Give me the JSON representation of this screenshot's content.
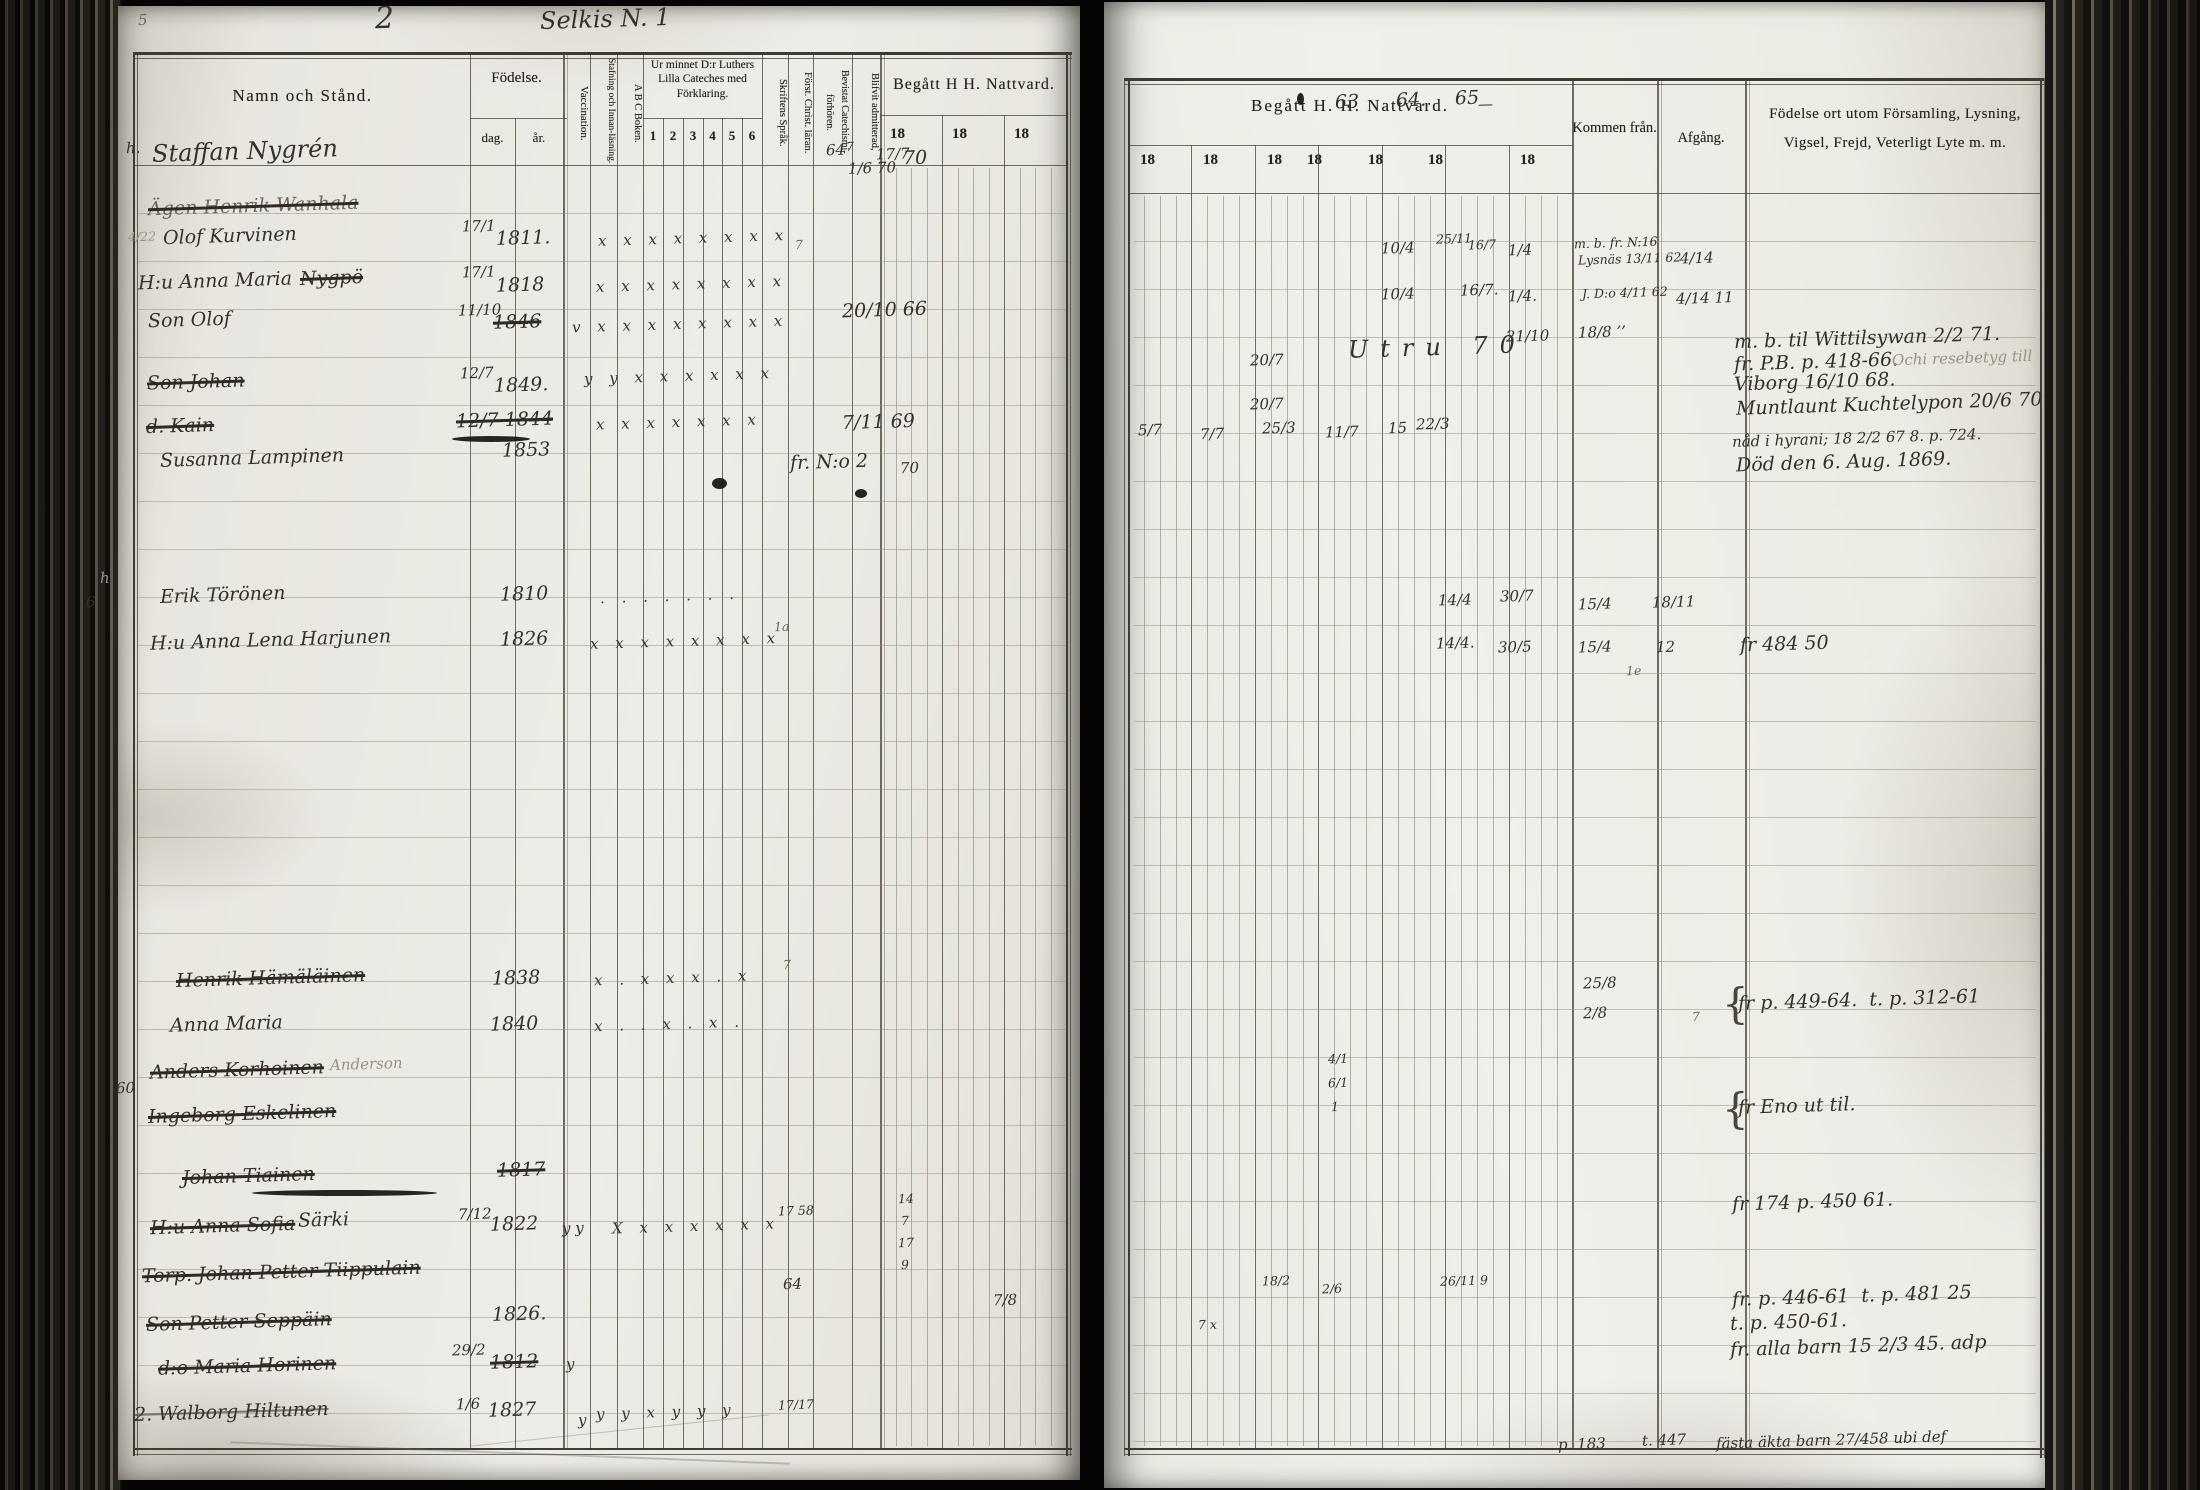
{
  "page_header": {
    "left_page_number": "5",
    "book_number": "2",
    "title": "Selkis N. 1"
  },
  "left_table": {
    "name_header": "Namn och Stånd.",
    "birth_header": "Födelse.",
    "birth_day": "dag.",
    "birth_year": "år.",
    "vaccination": "Vaccination.",
    "spelling": "Stafning och Innan-läsning.",
    "abc": "A B C Boken.",
    "catechism_header": "Ur minnet D:r Luthers Lilla Cateches med Förklaring.",
    "catechism_cols": [
      "1",
      "2",
      "3",
      "4",
      "5",
      "6"
    ],
    "script_lang": "Skriftens Språk.",
    "christ_doctrine": "Först. Christ. läran.",
    "catechism_meetings": "Bevistat Catechismi-förhören.",
    "admitted": "Blifvit admitterad,",
    "communion_header": "Begått H H. Nattvard.",
    "year_cols": [
      "18",
      "18",
      "18"
    ]
  },
  "right_table": {
    "communion_header": "Begått H. H. Nattvard.",
    "year_cols": [
      "18",
      "18",
      "18",
      "18",
      "18",
      "18",
      "18"
    ],
    "come_from": "Kommen från.",
    "departure": "Afgång.",
    "notes_header": "Födelse ort utom Församling, Lysning, Vigsel, Frejd, Veterligt Lyte m. m."
  },
  "annotations": [
    {
      "x": 138,
      "y": 12,
      "text": "5",
      "cls": "sm faint"
    },
    {
      "x": 375,
      "y": 2,
      "text": "2",
      "cls": "xl"
    },
    {
      "x": 540,
      "y": 6,
      "text": "Selkis N. 1",
      "cls": "lg"
    },
    {
      "x": 126,
      "y": 140,
      "text": "h.",
      "cls": "sm"
    },
    {
      "x": 152,
      "y": 138,
      "text": "Staffan Nygrén",
      "cls": "lg"
    },
    {
      "x": 148,
      "y": 196,
      "text": "Ägen Henrik Wanhala",
      "cls": "strike faint"
    },
    {
      "x": 128,
      "y": 230,
      "text": "4/22",
      "cls": "xs ghost"
    },
    {
      "x": 163,
      "y": 226,
      "text": "Olof Kurvinen"
    },
    {
      "x": 138,
      "y": 271,
      "text": "H:u Anna Maria"
    },
    {
      "x": 300,
      "y": 268,
      "text": "Nygpö",
      "cls": "strike"
    },
    {
      "x": 148,
      "y": 310,
      "text": "Son Olof"
    },
    {
      "x": 147,
      "y": 372,
      "text": "Son Johan",
      "cls": "strike"
    },
    {
      "x": 146,
      "y": 416,
      "text": "d. Kain",
      "cls": "strike"
    },
    {
      "x": 160,
      "y": 448,
      "text": "Susanna Lampinen"
    },
    {
      "x": 100,
      "y": 570,
      "text": "h",
      "cls": "sm ghost"
    },
    {
      "x": 86,
      "y": 594,
      "text": "6",
      "cls": "sm"
    },
    {
      "x": 160,
      "y": 585,
      "text": "Erik Törönen"
    },
    {
      "x": 150,
      "y": 630,
      "text": "H:u Anna Lena Harjunen"
    },
    {
      "x": 176,
      "y": 968,
      "text": "Henrik Hämäläinen",
      "cls": "strike"
    },
    {
      "x": 170,
      "y": 1014,
      "text": "Anna Maria"
    },
    {
      "x": 150,
      "y": 1060,
      "text": "Anders Korhoinen",
      "cls": "strike"
    },
    {
      "x": 330,
      "y": 1056,
      "text": "Anderson",
      "cls": "ghost sm"
    },
    {
      "x": 116,
      "y": 1080,
      "text": "60",
      "cls": "sm"
    },
    {
      "x": 148,
      "y": 1104,
      "text": "Ingeborg Eskelinen",
      "cls": "strike"
    },
    {
      "x": 182,
      "y": 1166,
      "text": "Johan Tiainen",
      "cls": "strike"
    },
    {
      "x": 150,
      "y": 1216,
      "text": "H:u Anna Sofia",
      "cls": "strike"
    },
    {
      "x": 298,
      "y": 1210,
      "text": "Särki"
    },
    {
      "x": 142,
      "y": 1262,
      "text": "Torp. Johan Petter Tiippulain",
      "cls": "strike"
    },
    {
      "x": 146,
      "y": 1312,
      "text": "Son Petter Seppäin",
      "cls": "strike"
    },
    {
      "x": 158,
      "y": 1356,
      "text": "d:o Maria Horinen",
      "cls": "strike"
    },
    {
      "x": 134,
      "y": 1402,
      "text": "2. Walborg Hiltunen",
      "cls": "strike-light"
    },
    {
      "x": 462,
      "y": 218,
      "text": "17/1",
      "cls": "sm"
    },
    {
      "x": 496,
      "y": 228,
      "text": "1811."
    },
    {
      "x": 462,
      "y": 264,
      "text": "17/1",
      "cls": "sm"
    },
    {
      "x": 496,
      "y": 275,
      "text": "1818"
    },
    {
      "x": 458,
      "y": 302,
      "text": "11/10",
      "cls": "sm"
    },
    {
      "x": 493,
      "y": 312,
      "text": "1846",
      "cls": "strike"
    },
    {
      "x": 460,
      "y": 365,
      "text": "12/7",
      "cls": "sm"
    },
    {
      "x": 494,
      "y": 375,
      "text": "1849."
    },
    {
      "x": 456,
      "y": 410,
      "text": "12/7 1844",
      "cls": "strike"
    },
    {
      "x": 502,
      "y": 440,
      "text": "1853"
    },
    {
      "x": 500,
      "y": 584,
      "text": "1810"
    },
    {
      "x": 500,
      "y": 629,
      "text": "1826"
    },
    {
      "x": 492,
      "y": 968,
      "text": "1838"
    },
    {
      "x": 490,
      "y": 1014,
      "text": "1840"
    },
    {
      "x": 497,
      "y": 1160,
      "text": "1817",
      "cls": "strike"
    },
    {
      "x": 458,
      "y": 1206,
      "text": "7/12",
      "cls": "sm"
    },
    {
      "x": 490,
      "y": 1214,
      "text": "1822"
    },
    {
      "x": 492,
      "y": 1304,
      "text": "1826."
    },
    {
      "x": 452,
      "y": 1342,
      "text": "29/2",
      "cls": "sm"
    },
    {
      "x": 490,
      "y": 1352,
      "text": "1812",
      "cls": "strike"
    },
    {
      "x": 456,
      "y": 1396,
      "text": "1/6",
      "cls": "sm"
    },
    {
      "x": 488,
      "y": 1400,
      "text": "1827"
    },
    {
      "x": 598,
      "y": 230,
      "text": "x x x x x x x x",
      "cls": "marks"
    },
    {
      "x": 596,
      "y": 276,
      "text": "x x x x x x x x",
      "cls": "marks"
    },
    {
      "x": 572,
      "y": 316,
      "text": "v x x x x x x x x",
      "cls": "marks"
    },
    {
      "x": 584,
      "y": 368,
      "text": "y y x x x x x x",
      "cls": "marks"
    },
    {
      "x": 596,
      "y": 414,
      "text": "x x x x x x x",
      "cls": "marks faint"
    },
    {
      "x": 600,
      "y": 588,
      "text": ". . . . . . .",
      "cls": "marks faint"
    },
    {
      "x": 590,
      "y": 633,
      "text": "x x x x x x x x",
      "cls": "marks"
    },
    {
      "x": 594,
      "y": 970,
      "text": "x . x x x . x",
      "cls": "marks faint"
    },
    {
      "x": 594,
      "y": 1016,
      "text": "x . . x . x .",
      "cls": "marks faint"
    },
    {
      "x": 562,
      "y": 1220,
      "text": "y y",
      "cls": "sm"
    },
    {
      "x": 612,
      "y": 1218,
      "text": "X x x x x x x",
      "cls": "marks"
    },
    {
      "x": 566,
      "y": 1356,
      "text": "y",
      "cls": "sm"
    },
    {
      "x": 578,
      "y": 1412,
      "text": "y",
      "cls": "sm"
    },
    {
      "x": 596,
      "y": 1404,
      "text": "y y x y y y",
      "cls": "marks"
    },
    {
      "x": 826,
      "y": 142,
      "text": "64",
      "cls": "sm"
    },
    {
      "x": 846,
      "y": 140,
      "text": "7",
      "cls": "xs"
    },
    {
      "x": 848,
      "y": 160,
      "text": "1/6 70",
      "cls": "sm"
    },
    {
      "x": 876,
      "y": 146,
      "text": "17/7",
      "cls": "sm"
    },
    {
      "x": 903,
      "y": 148,
      "text": "70"
    },
    {
      "x": 795,
      "y": 238,
      "text": "7",
      "cls": "xs faint"
    },
    {
      "x": 842,
      "y": 300,
      "text": "20/10 66"
    },
    {
      "x": 842,
      "y": 412,
      "text": "7/11 69"
    },
    {
      "x": 790,
      "y": 452,
      "text": "fr. N:o 2"
    },
    {
      "x": 900,
      "y": 460,
      "text": "70",
      "cls": "sm"
    },
    {
      "x": 774,
      "y": 620,
      "text": "1a",
      "cls": "xs faint"
    },
    {
      "x": 783,
      "y": 958,
      "text": "7",
      "cls": "xs faint"
    },
    {
      "x": 778,
      "y": 1204,
      "text": "17 58",
      "cls": "xs"
    },
    {
      "x": 898,
      "y": 1192,
      "text": "14",
      "cls": "xs"
    },
    {
      "x": 901,
      "y": 1214,
      "text": "7",
      "cls": "xs"
    },
    {
      "x": 898,
      "y": 1236,
      "text": "17",
      "cls": "xs"
    },
    {
      "x": 901,
      "y": 1258,
      "text": "9",
      "cls": "xs"
    },
    {
      "x": 783,
      "y": 1276,
      "text": "64",
      "cls": "sm"
    },
    {
      "x": 993,
      "y": 1292,
      "text": "7/8",
      "cls": "sm"
    },
    {
      "x": 778,
      "y": 1398,
      "text": "17/17",
      "cls": "xs"
    },
    {
      "x": 1335,
      "y": 92,
      "text": "63"
    },
    {
      "x": 1396,
      "y": 90,
      "text": "64."
    },
    {
      "x": 1455,
      "y": 88,
      "text": "65"
    },
    {
      "x": 1478,
      "y": 96,
      "text": "—",
      "cls": "sm"
    },
    {
      "x": 1381,
      "y": 240,
      "text": "10/4",
      "cls": "sm"
    },
    {
      "x": 1436,
      "y": 232,
      "text": "25/11",
      "cls": "xs"
    },
    {
      "x": 1468,
      "y": 238,
      "text": "16/7",
      "cls": "xs"
    },
    {
      "x": 1508,
      "y": 242,
      "text": "1/4",
      "cls": "sm"
    },
    {
      "x": 1574,
      "y": 236,
      "text": "m. b. fr. N:16",
      "cls": "xs"
    },
    {
      "x": 1578,
      "y": 252,
      "text": "Lysnäs 13/11 62",
      "cls": "xs"
    },
    {
      "x": 1680,
      "y": 250,
      "text": "4/14",
      "cls": "sm"
    },
    {
      "x": 1381,
      "y": 286,
      "text": "10/4",
      "cls": "sm"
    },
    {
      "x": 1460,
      "y": 282,
      "text": "16/7.",
      "cls": "sm"
    },
    {
      "x": 1508,
      "y": 288,
      "text": "1/4.",
      "cls": "sm"
    },
    {
      "x": 1582,
      "y": 286,
      "text": "J. D:o 4/11 62",
      "cls": "xs"
    },
    {
      "x": 1676,
      "y": 290,
      "text": "4/14 11",
      "cls": "sm"
    },
    {
      "x": 1348,
      "y": 334,
      "text": "Utru 70",
      "cls": "lg wide"
    },
    {
      "x": 1506,
      "y": 328,
      "text": "21/10",
      "cls": "sm"
    },
    {
      "x": 1578,
      "y": 324,
      "text": "18/8 ’’",
      "cls": "sm"
    },
    {
      "x": 1250,
      "y": 352,
      "text": "20/7",
      "cls": "sm"
    },
    {
      "x": 1250,
      "y": 396,
      "text": "20/7",
      "cls": "sm"
    },
    {
      "x": 1138,
      "y": 422,
      "text": "5/7",
      "cls": "sm"
    },
    {
      "x": 1200,
      "y": 426,
      "text": "7/7",
      "cls": "sm"
    },
    {
      "x": 1262,
      "y": 420,
      "text": "25/3",
      "cls": "sm"
    },
    {
      "x": 1325,
      "y": 424,
      "text": "11/7",
      "cls": "sm"
    },
    {
      "x": 1388,
      "y": 420,
      "text": "15",
      "cls": "sm"
    },
    {
      "x": 1416,
      "y": 416,
      "text": "22/3",
      "cls": "sm"
    },
    {
      "x": 1734,
      "y": 328,
      "text": "m. b. til Wittilsywan 2/2 71."
    },
    {
      "x": 1734,
      "y": 352,
      "text": "fr. P.B. p. 418-66."
    },
    {
      "x": 1892,
      "y": 350,
      "text": "Ochi resebetyg till",
      "cls": "sm ghost"
    },
    {
      "x": 1734,
      "y": 372,
      "text": "Viborg 16/10 68."
    },
    {
      "x": 1736,
      "y": 394,
      "text": "Muntlaunt Kuchtelypon 20/6 70"
    },
    {
      "x": 1732,
      "y": 430,
      "text": "nåd i hyrani; 18 2/2 67 8. p. 724.",
      "cls": "sm"
    },
    {
      "x": 1736,
      "y": 452,
      "text": "Död den 6. Aug. 1869."
    },
    {
      "x": 1438,
      "y": 592,
      "text": "14/4",
      "cls": "sm"
    },
    {
      "x": 1500,
      "y": 588,
      "text": "30/7",
      "cls": "sm"
    },
    {
      "x": 1578,
      "y": 596,
      "text": "15/4",
      "cls": "sm"
    },
    {
      "x": 1652,
      "y": 594,
      "text": "18/11",
      "cls": "sm"
    },
    {
      "x": 1436,
      "y": 635,
      "text": "14/4.",
      "cls": "sm"
    },
    {
      "x": 1498,
      "y": 639,
      "text": "30/5",
      "cls": "sm"
    },
    {
      "x": 1578,
      "y": 639,
      "text": "15/4",
      "cls": "sm"
    },
    {
      "x": 1656,
      "y": 639,
      "text": "12",
      "cls": "sm"
    },
    {
      "x": 1626,
      "y": 664,
      "text": "1e",
      "cls": "xs faint"
    },
    {
      "x": 1740,
      "y": 634,
      "text": "fr 484 50"
    },
    {
      "x": 1583,
      "y": 975,
      "text": "25/8",
      "cls": "sm"
    },
    {
      "x": 1583,
      "y": 1005,
      "text": "2/8",
      "cls": "sm"
    },
    {
      "x": 1692,
      "y": 1010,
      "text": "7",
      "cls": "xs faint"
    },
    {
      "x": 1722,
      "y": 980,
      "text": "{",
      "cls": "brace"
    },
    {
      "x": 1738,
      "y": 990,
      "text": "fr p. 449-64.  t. p. 312-61"
    },
    {
      "x": 1722,
      "y": 1085,
      "text": "{",
      "cls": "brace"
    },
    {
      "x": 1738,
      "y": 1096,
      "text": "fr Eno ut til."
    },
    {
      "x": 1328,
      "y": 1052,
      "text": "4/1",
      "cls": "xs"
    },
    {
      "x": 1328,
      "y": 1076,
      "text": "6/1",
      "cls": "xs"
    },
    {
      "x": 1331,
      "y": 1100,
      "text": "1",
      "cls": "xs"
    },
    {
      "x": 1262,
      "y": 1274,
      "text": "18/2",
      "cls": "xs"
    },
    {
      "x": 1322,
      "y": 1282,
      "text": "2/6",
      "cls": "xs"
    },
    {
      "x": 1440,
      "y": 1274,
      "text": "26/11 9",
      "cls": "xs"
    },
    {
      "x": 1198,
      "y": 1318,
      "text": "7 x",
      "cls": "xs"
    },
    {
      "x": 1732,
      "y": 1192,
      "text": "fr 174 p. 450 61."
    },
    {
      "x": 1732,
      "y": 1286,
      "text": "fr. p. 446-61  t. p. 481 25"
    },
    {
      "x": 1730,
      "y": 1312,
      "text": "t. p. 450-61."
    },
    {
      "x": 1730,
      "y": 1336,
      "text": "fr. alla barn 15 2/3 45. adp"
    },
    {
      "x": 1558,
      "y": 1436,
      "text": "p. 183",
      "cls": "sm"
    },
    {
      "x": 1642,
      "y": 1432,
      "text": "t. 447",
      "cls": "sm"
    },
    {
      "x": 1716,
      "y": 1432,
      "text": "fästa äkta barn 27/458 ubi def",
      "cls": "sm"
    }
  ],
  "blobs": [
    {
      "x": 712,
      "y": 478,
      "w": 15,
      "h": 11
    },
    {
      "x": 855,
      "y": 489,
      "w": 12,
      "h": 9
    },
    {
      "x": 1297,
      "y": 93,
      "w": 7,
      "h": 12
    },
    {
      "x": 452,
      "y": 436,
      "w": 78,
      "h": 6
    },
    {
      "x": 252,
      "y": 1190,
      "w": 185,
      "h": 6
    }
  ]
}
